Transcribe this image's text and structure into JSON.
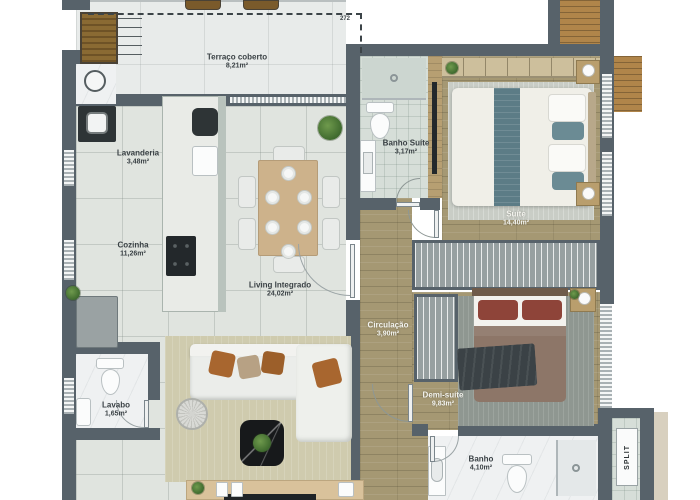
{
  "plan": {
    "title": "apartment-floor-plan",
    "rooms": [
      {
        "id": "terraco",
        "name": "Terraço coberto",
        "area": "8,21m²"
      },
      {
        "id": "lavanderia",
        "name": "Lavanderia",
        "area": "3,48m²"
      },
      {
        "id": "cozinha",
        "name": "Cozinha",
        "area": "11,26m²"
      },
      {
        "id": "living",
        "name": "Living Integrado",
        "area": "24,02m²"
      },
      {
        "id": "banho_suite",
        "name": "Banho Suíte",
        "area": "3,17m²"
      },
      {
        "id": "suite",
        "name": "Suíte",
        "area": "14,40m²"
      },
      {
        "id": "circulacao",
        "name": "Circulação",
        "area": "3,90m²"
      },
      {
        "id": "demi_suite",
        "name": "Demi-suíte",
        "area": "9,83m²"
      },
      {
        "id": "banho",
        "name": "Banho",
        "area": "4,10m²"
      },
      {
        "id": "lavabo",
        "name": "Lavabo",
        "area": "1,65m²"
      }
    ],
    "annotations": {
      "split": "SPLIT",
      "dim_272": "272"
    },
    "colors": {
      "wall": "#57626a",
      "wood_floor": "#a59873",
      "living_tile": "#e0e4df",
      "accent_teal": "#5c7c86",
      "rug_living": "#cfcbae",
      "rug_suite": "#c9cdc6",
      "rug_demi": "#8f9791",
      "bed_demi_cover": "#8d7668",
      "pillow_orange": "#a8662f",
      "pillow_maroon": "#8e4439"
    }
  }
}
